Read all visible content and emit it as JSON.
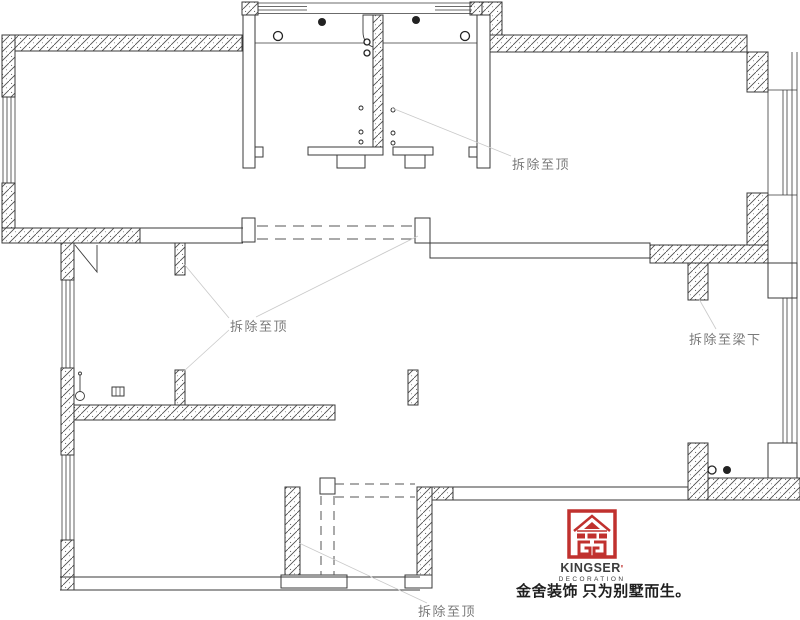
{
  "annotations": [
    {
      "id": "demolish-to-ceiling-top",
      "text": "拆除至顶"
    },
    {
      "id": "demolish-to-ceiling-left",
      "text": "拆除至顶"
    },
    {
      "id": "demolish-to-beam",
      "text": "拆除至梁下"
    },
    {
      "id": "demolish-to-ceiling-bottom",
      "text": "拆除至顶"
    }
  ],
  "logo": {
    "brand": "KINGSER",
    "mark": "'",
    "subtitle": "DECORATION",
    "tagline": "金舍装饰 只为别墅而生。"
  },
  "colors": {
    "logo-red": "#c0312e",
    "label-gray": "#7a7a7a",
    "wall-line": "#3a3a3a",
    "tagline-ink": "#1f1f1f"
  }
}
